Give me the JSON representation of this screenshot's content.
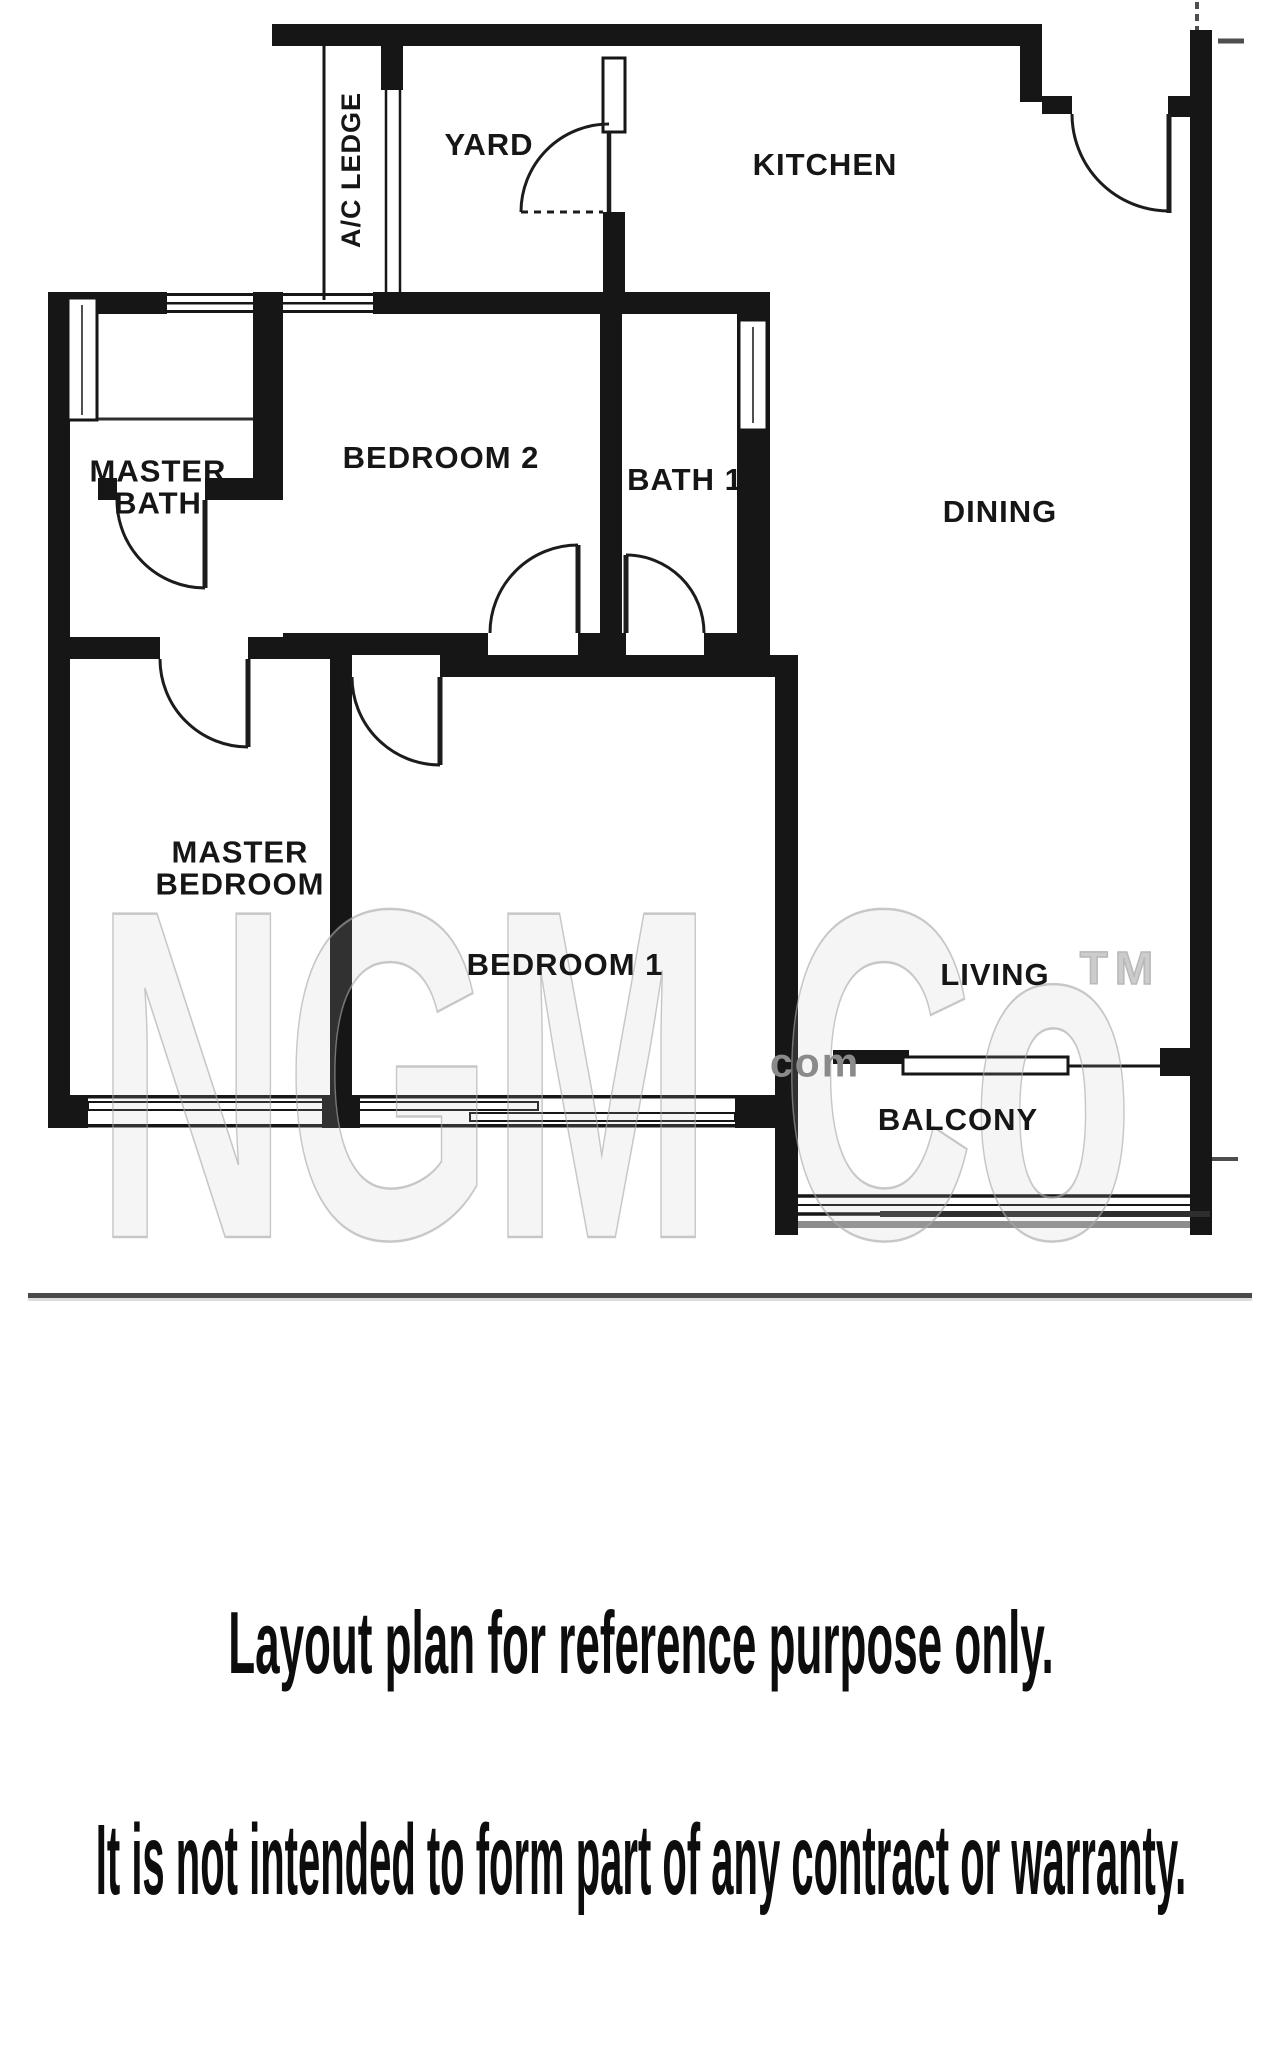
{
  "document": {
    "type": "apartment floor plan (scanned)",
    "background": "#ffffff"
  },
  "plan": {
    "rooms": [
      {
        "id": "ac-ledge",
        "label": "A/C LEDGE"
      },
      {
        "id": "yard",
        "label": "YARD"
      },
      {
        "id": "kitchen",
        "label": "KITCHEN"
      },
      {
        "id": "master-bath",
        "lines": [
          "MASTER",
          "BATH"
        ]
      },
      {
        "id": "bedroom-2",
        "label": "BEDROOM 2"
      },
      {
        "id": "bath-1",
        "label": "BATH 1"
      },
      {
        "id": "dining",
        "label": "DINING"
      },
      {
        "id": "master-bedroom",
        "lines": [
          "MASTER",
          "BEDROOM"
        ]
      },
      {
        "id": "bedroom-1",
        "label": "BEDROOM 1"
      },
      {
        "id": "living",
        "label": "LIVING"
      },
      {
        "id": "balcony",
        "label": "BALCONY"
      }
    ],
    "watermark": {
      "brand": "NGM Co",
      "suffix": "com",
      "trademark": "TM"
    }
  },
  "disclaimer": {
    "line1": "Layout plan for reference purpose only.",
    "line2": "It is not intended to form part of any contract or warranty."
  },
  "colors": {
    "wall": "#161616",
    "door_stroke": "#1c1c1c",
    "label": "#161616",
    "watermark_gray": "#c3c3c3",
    "separator": "#4a4a4a",
    "railing_gray": "#8c8c8c"
  }
}
